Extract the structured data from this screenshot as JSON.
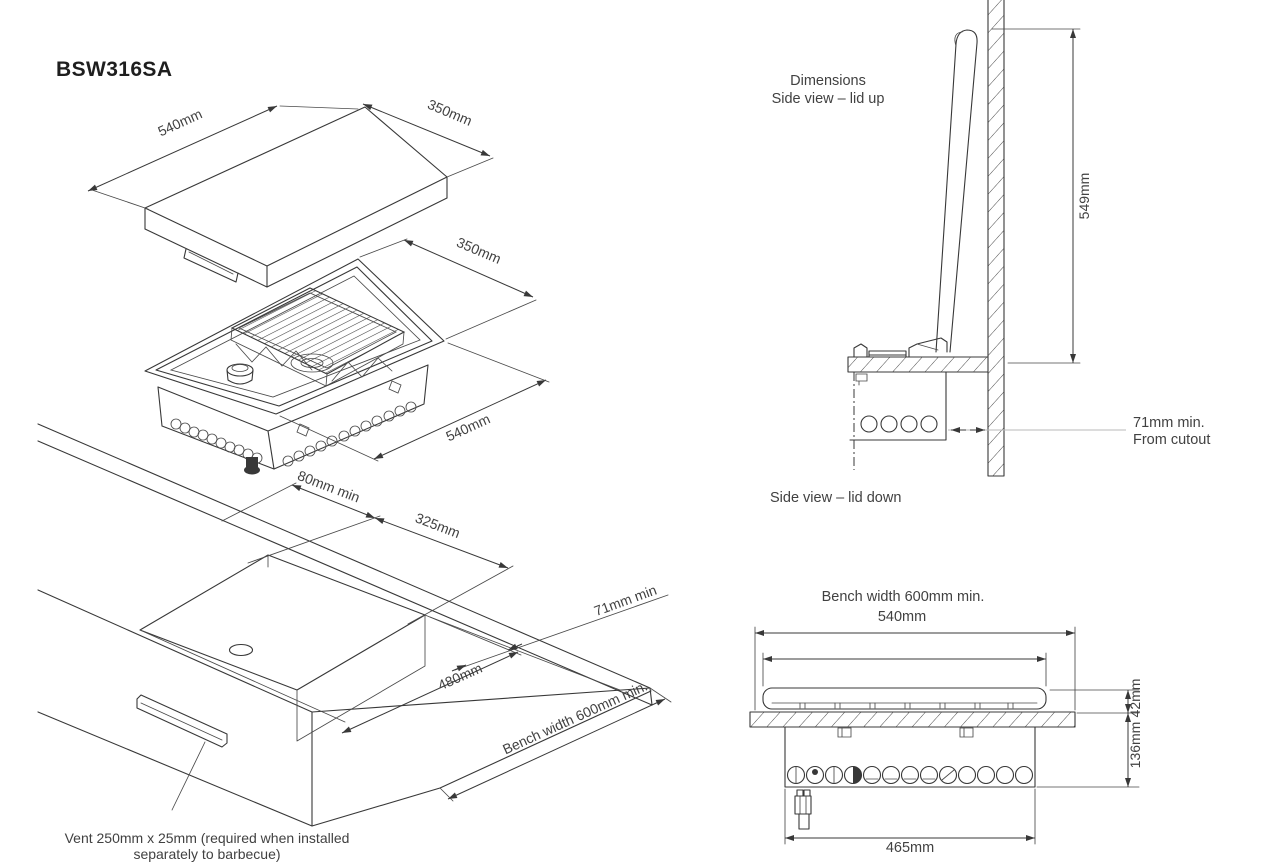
{
  "title": "BSW316SA",
  "colors": {
    "line": "#383838",
    "text": "#414141",
    "leader_gray": "#b9b9b9",
    "background": "#ffffff"
  },
  "lid_iso": {
    "dim_length": "540mm",
    "dim_width": "350mm"
  },
  "burner_iso": {
    "dim_width": "350mm",
    "dim_length": "540mm"
  },
  "bench_iso": {
    "dim_rear": "80mm min",
    "dim_cutout_width": "325mm",
    "dim_side": "71mm min",
    "dim_cutout_depth": "480mm",
    "dim_bench": "Bench width 600mm min.",
    "vent_note_line1": "Vent 250mm x 25mm (required when installed",
    "vent_note_line2": "separately to barbecue)"
  },
  "side_view_up": {
    "caption_line1": "Dimensions",
    "caption_line2": "Side view – lid up",
    "dim_height": "549mm",
    "clearance_line1": "71mm min.",
    "clearance_line2": "From cutout"
  },
  "side_view_down": {
    "caption": "Side view – lid down"
  },
  "front_view": {
    "dim_bench": "Bench width 600mm min.",
    "dim_top": "540mm",
    "dim_lid": "42mm",
    "dim_depth": "136mm",
    "dim_body": "465mm"
  }
}
